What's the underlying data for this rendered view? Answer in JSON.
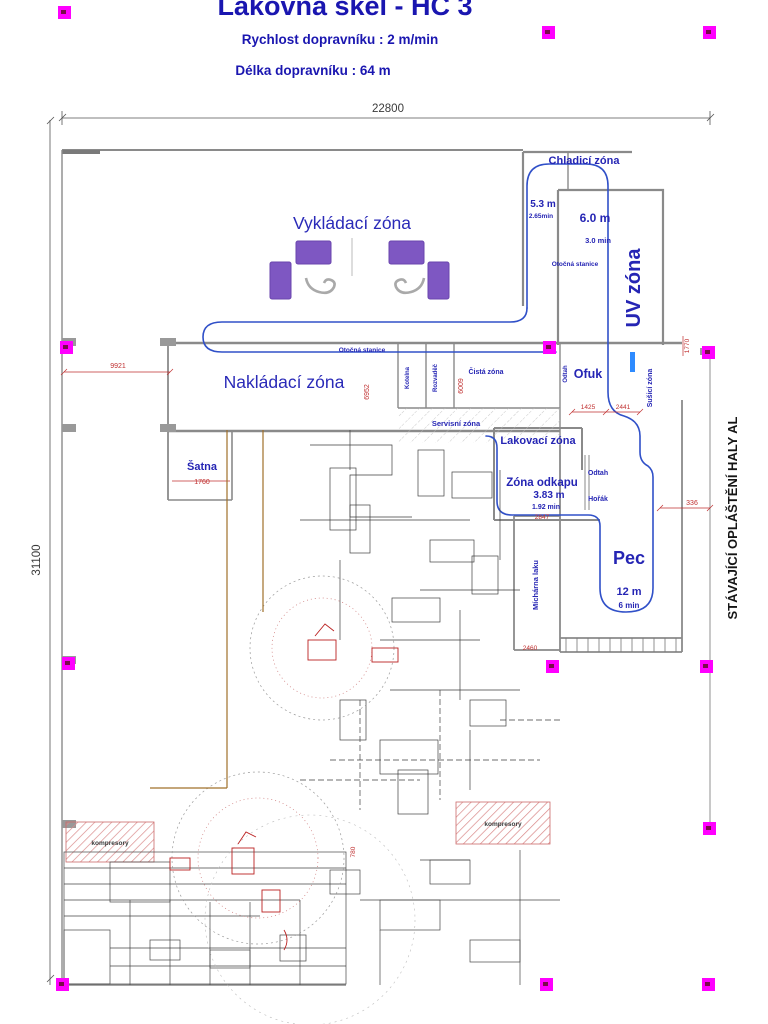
{
  "header": {
    "title": "Lakovna skel - HC 3",
    "line1": "Rychlost dopravníku : 2 m/min",
    "line2": "Délka dopravníku : 64 m"
  },
  "side_note": "STÁVAJÍCÍ OPLÁŠTĚNÍ HALY AL",
  "zones": {
    "vykladaci": "Vykládací zóna",
    "nakladaci": "Nakládací zóna",
    "chladici": "Chladicí zóna",
    "uv": "UV zóna",
    "ofuk": "Ofuk",
    "susici": "Sušicí zóna",
    "lakovaci": "Lakovací zóna",
    "odkap": "Zóna odkapu",
    "pec": "Pec",
    "satna": "Šatna",
    "cista": "Čistá zóna",
    "servisni": "Servisní zóna",
    "micharna": "Míchárna laku",
    "otocna_a": "Otočná stanice",
    "otocna_b": "Otočná stanice",
    "odtah_a": "Odtah",
    "odtah_b": "Odtah",
    "horak": "Hořák",
    "kotelna": "Kotelna",
    "rozvadec": "Rozvaděč",
    "kompresory_a": "kompresory",
    "kompresory_b": "kompresory"
  },
  "measure": {
    "chladici_m": "5.3 m",
    "chladici_t": "2.65min",
    "uv_m": "6.0 m",
    "uv_t": "3.0 min",
    "odkap_m": "3.83 m",
    "odkap_t": "1.92 min",
    "pec_m": "12 m",
    "pec_t": "6 min"
  },
  "dims": {
    "total_w": "22800",
    "total_h": "31100",
    "d1": "9921",
    "d2": "6952",
    "d3": "6009",
    "d4": "1760",
    "d5": "2847",
    "d6": "1425",
    "d7": "2441",
    "d8": "336",
    "d9": "1770",
    "d10": "2460",
    "d11": "780"
  },
  "colors": {
    "accent": "#1a16b0",
    "conveyor": "#3050c8",
    "dims_red": "#c03030",
    "marker": "#ff00ff",
    "pallet": "#7e57c2",
    "wall": "#8a8a8a"
  }
}
